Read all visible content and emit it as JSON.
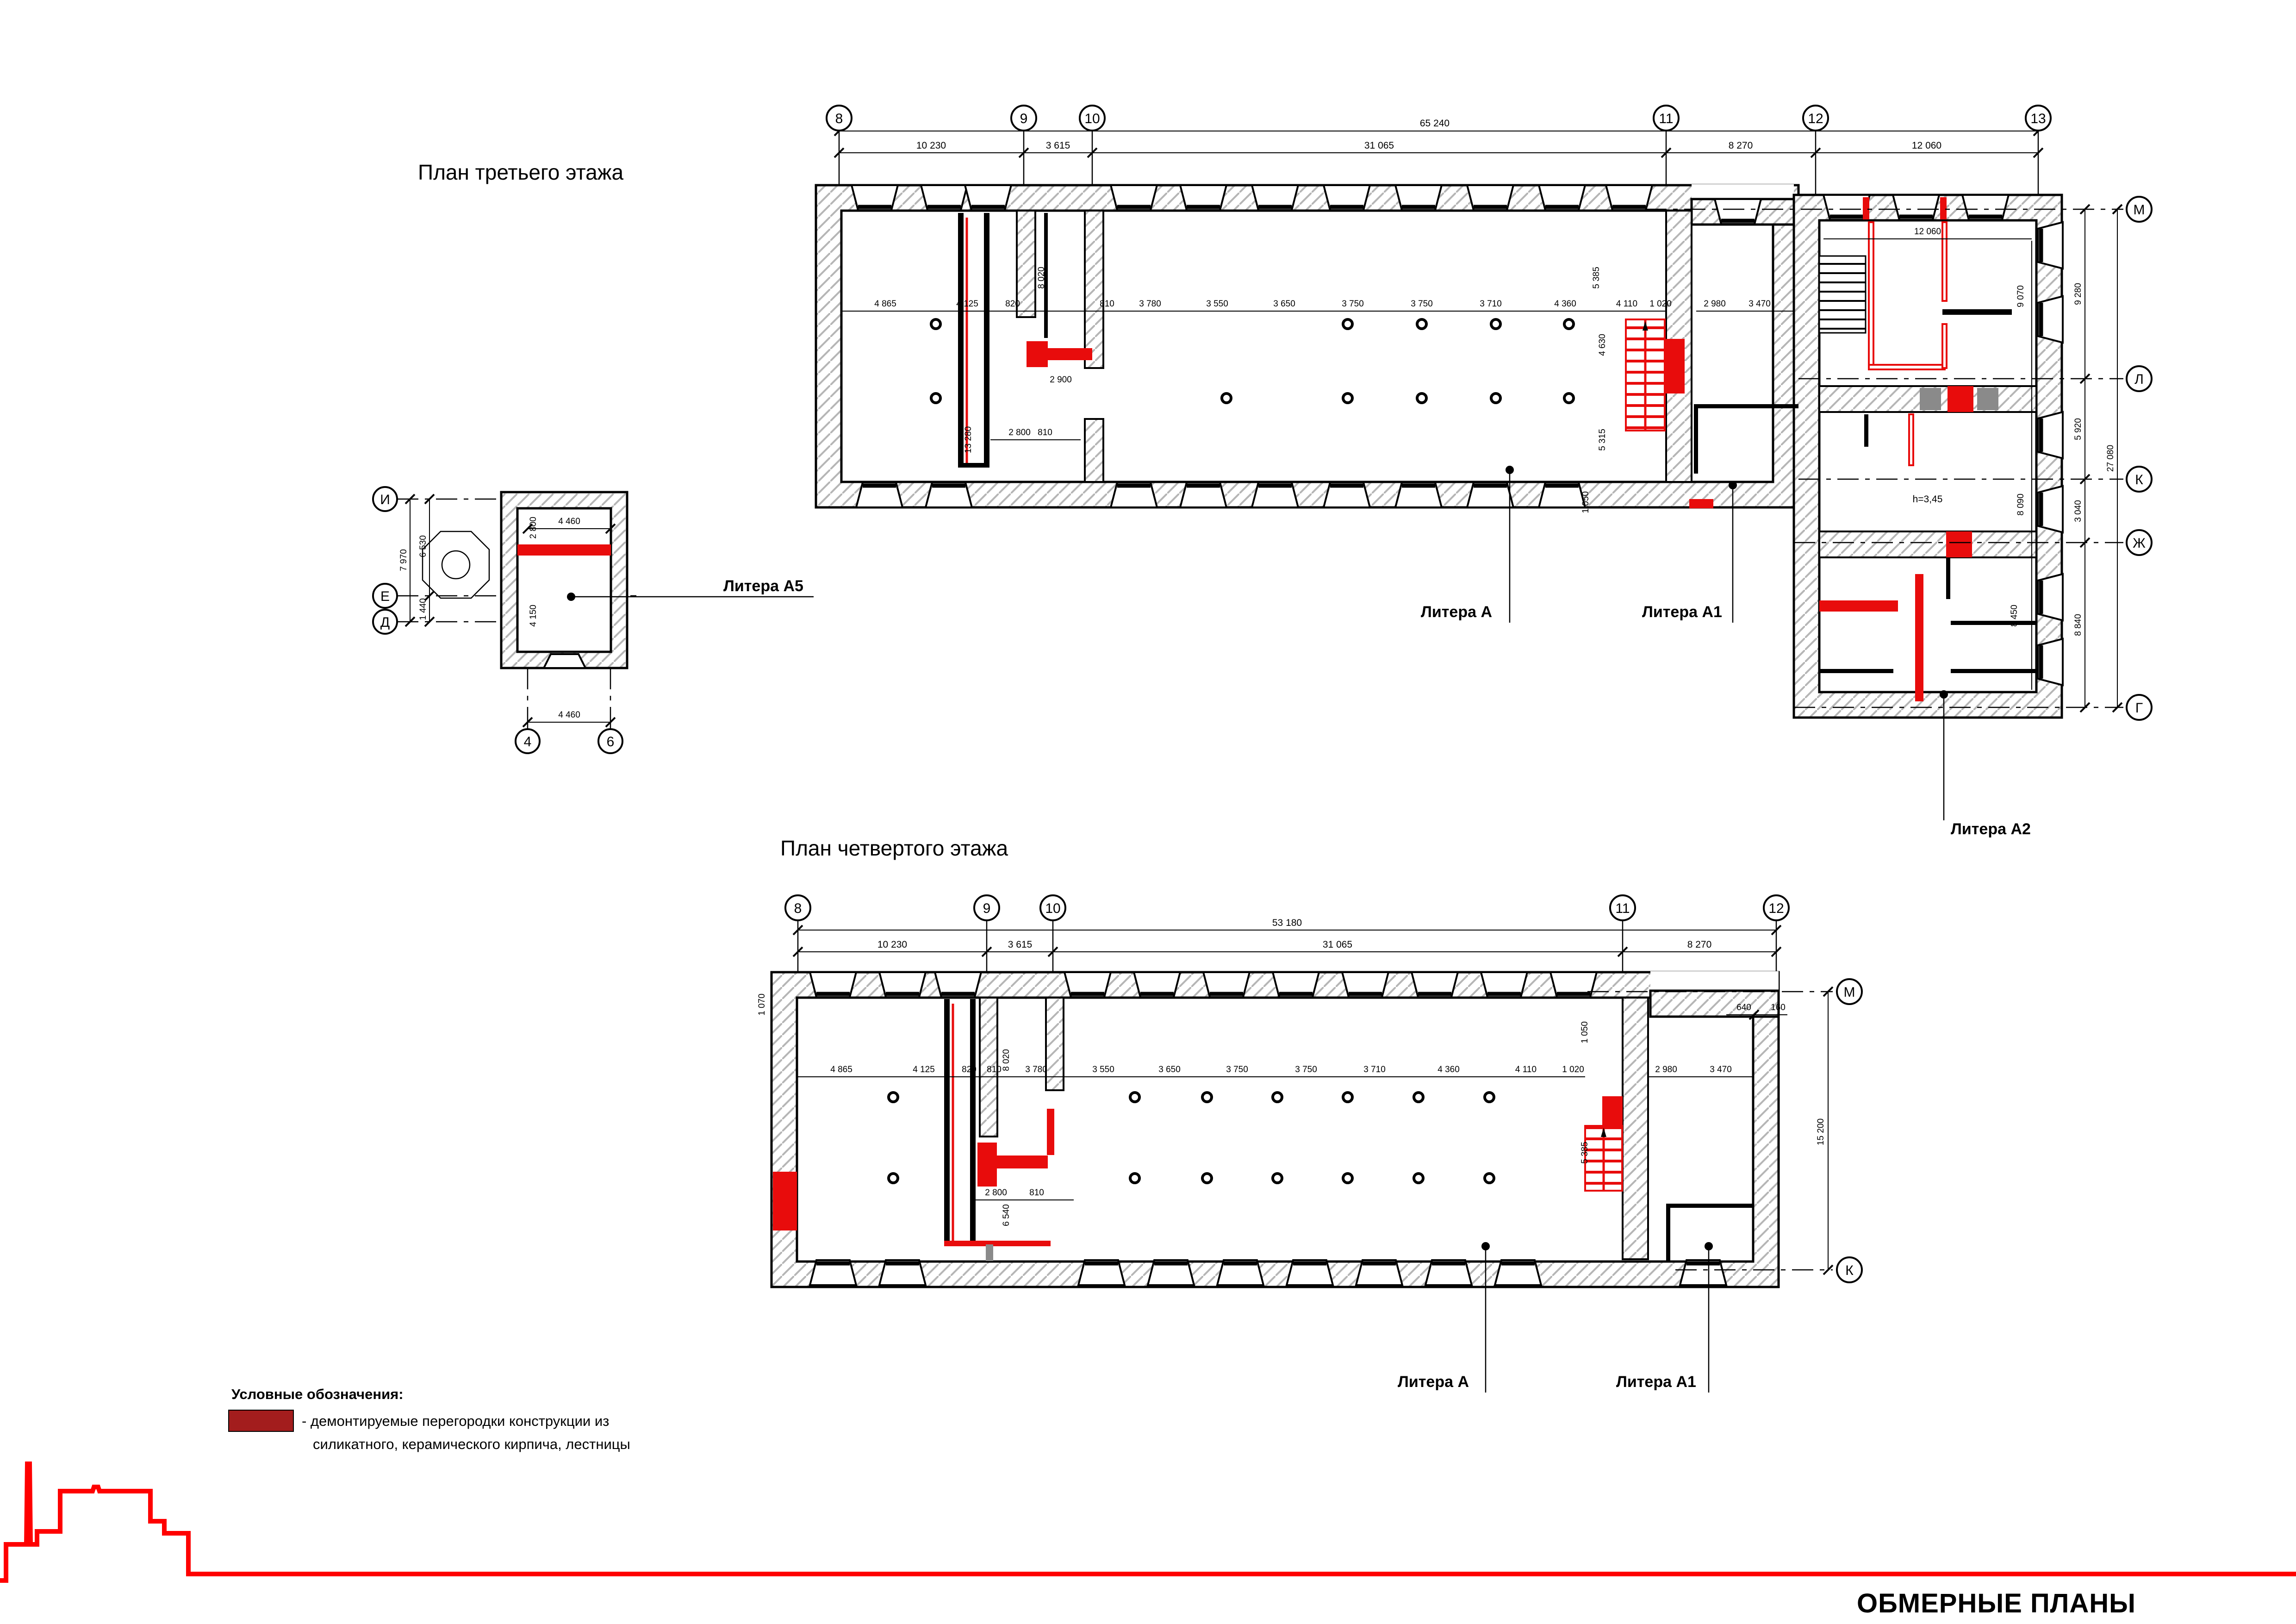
{
  "titles": {
    "plan3": "План третьего этажа",
    "plan4": "План четвертого этажа",
    "sheet": "ОБМЕРНЫЕ ПЛАНЫ"
  },
  "legend": {
    "heading": "Условные обозначения:",
    "item_line1": "- демонтируемые перегородки конструкции из",
    "item_line2": "силикатного, керамического кирпича, лестницы"
  },
  "colors": {
    "demolition_red": "#e80c0c",
    "legend_swatch": "#a31d1d",
    "gray_block": "#8a8a8a",
    "profile_red": "#ff0000"
  },
  "p3": {
    "axes_top": [
      "8",
      "9",
      "10",
      "11",
      "12",
      "13"
    ],
    "total": "65 240",
    "dims_top": [
      "10 230",
      "3 615",
      "31 065",
      "8 270",
      "12 060"
    ],
    "dims_room": [
      "4 865",
      "4 125",
      "820",
      "810",
      "3 780",
      "3 550",
      "3 650",
      "3 750",
      "3 750",
      "3 710",
      "4 360",
      "4 110",
      "1 020",
      "2 980",
      "3 470"
    ],
    "dims_v": [
      "8 020",
      "13 280",
      "5 385",
      "4 630",
      "5 315",
      "1 050"
    ],
    "dims_misc": [
      "2 800",
      "810",
      "2 900"
    ],
    "labels": {
      "a": "Литера А",
      "a1": "Литера А1",
      "a2": "Литера А2"
    },
    "wing": {
      "axes": [
        "М",
        "Л",
        "К",
        "Ж",
        "Г"
      ],
      "dims_axis": [
        "9 280",
        "5 920",
        "3 040",
        "8 840"
      ],
      "dim_total": "27 080",
      "dims_inner": [
        "12 060",
        "9 070",
        "8 090",
        "8 450"
      ],
      "height_note": "h=3,45"
    }
  },
  "p5": {
    "label": "Литера А5",
    "axes_left": [
      "И",
      "Е",
      "Д"
    ],
    "axes_bottom": [
      "4",
      "6"
    ],
    "dims_v": [
      "7 970",
      "6 530",
      "1 440",
      "2 800",
      "4 150"
    ],
    "dims_h": [
      "4 460",
      "4 460"
    ]
  },
  "p4": {
    "axes_top": [
      "8",
      "9",
      "10",
      "11",
      "12"
    ],
    "axes_right": [
      "М",
      "К"
    ],
    "total": "53 180",
    "dims_top": [
      "10 230",
      "3 615",
      "31 065",
      "8 270"
    ],
    "dims_room": [
      "4 865",
      "4 125",
      "820",
      "810",
      "3 780",
      "3 550",
      "3 650",
      "3 750",
      "3 750",
      "3 710",
      "4 360",
      "4 110",
      "1 020",
      "2 980",
      "3 470"
    ],
    "dims_v": [
      "8 020",
      "6 540",
      "1 050",
      "5 385",
      "15 200",
      "1 070"
    ],
    "dims_misc": [
      "2 800",
      "810",
      "640",
      "160"
    ],
    "labels": {
      "a": "Литера А",
      "a1": "Литера А1"
    }
  }
}
